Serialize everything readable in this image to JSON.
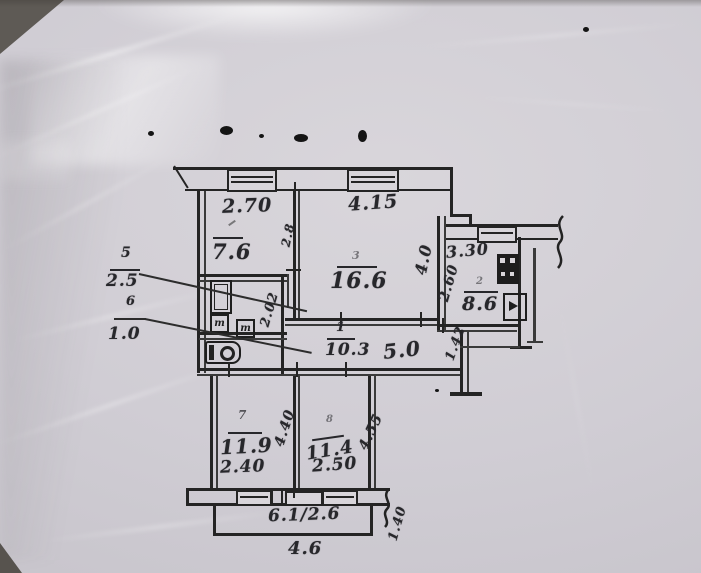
{
  "meta": {
    "description": "Scanned apartment floor plan (technical passport drawing) photographed in a crumpled plastic sleeve"
  },
  "colors": {
    "paper": "#d3d0d6",
    "ink": "#262626",
    "backdrop_dark": "#5e5a55"
  },
  "plan": {
    "top_row": {
      "room_small": {
        "number_mark": "",
        "area": "7.6",
        "width": "2.70",
        "depth": "2.8"
      },
      "room_large": {
        "number_mark": "3",
        "area": "16.6",
        "width": "4.15",
        "depth": "4.0"
      },
      "kitchen": {
        "number_mark": "2",
        "area": "8.6",
        "width": "3.30",
        "depth": "2.60"
      }
    },
    "side_labels": {
      "bathroom": {
        "number": "5",
        "area": "2.5"
      },
      "wc": {
        "number": "6",
        "area": "1.0"
      }
    },
    "hall": {
      "number": "1",
      "area": "10.3",
      "length": "5.0",
      "entry_depth": "1.42",
      "inner_depth": "2.02"
    },
    "bottom_row": {
      "room_left": {
        "number": "7",
        "area": "11.9",
        "width": "2.40",
        "depth": "4.40"
      },
      "room_right": {
        "number": "8",
        "area": "11.4",
        "width": "2.50",
        "depth": "4.55"
      }
    },
    "balcony": {
      "area_label": "6.1/2.6",
      "width": "4.6",
      "side": "1.40"
    },
    "fixtures": {
      "tub_mark": "т",
      "basin_mark": "т"
    }
  }
}
